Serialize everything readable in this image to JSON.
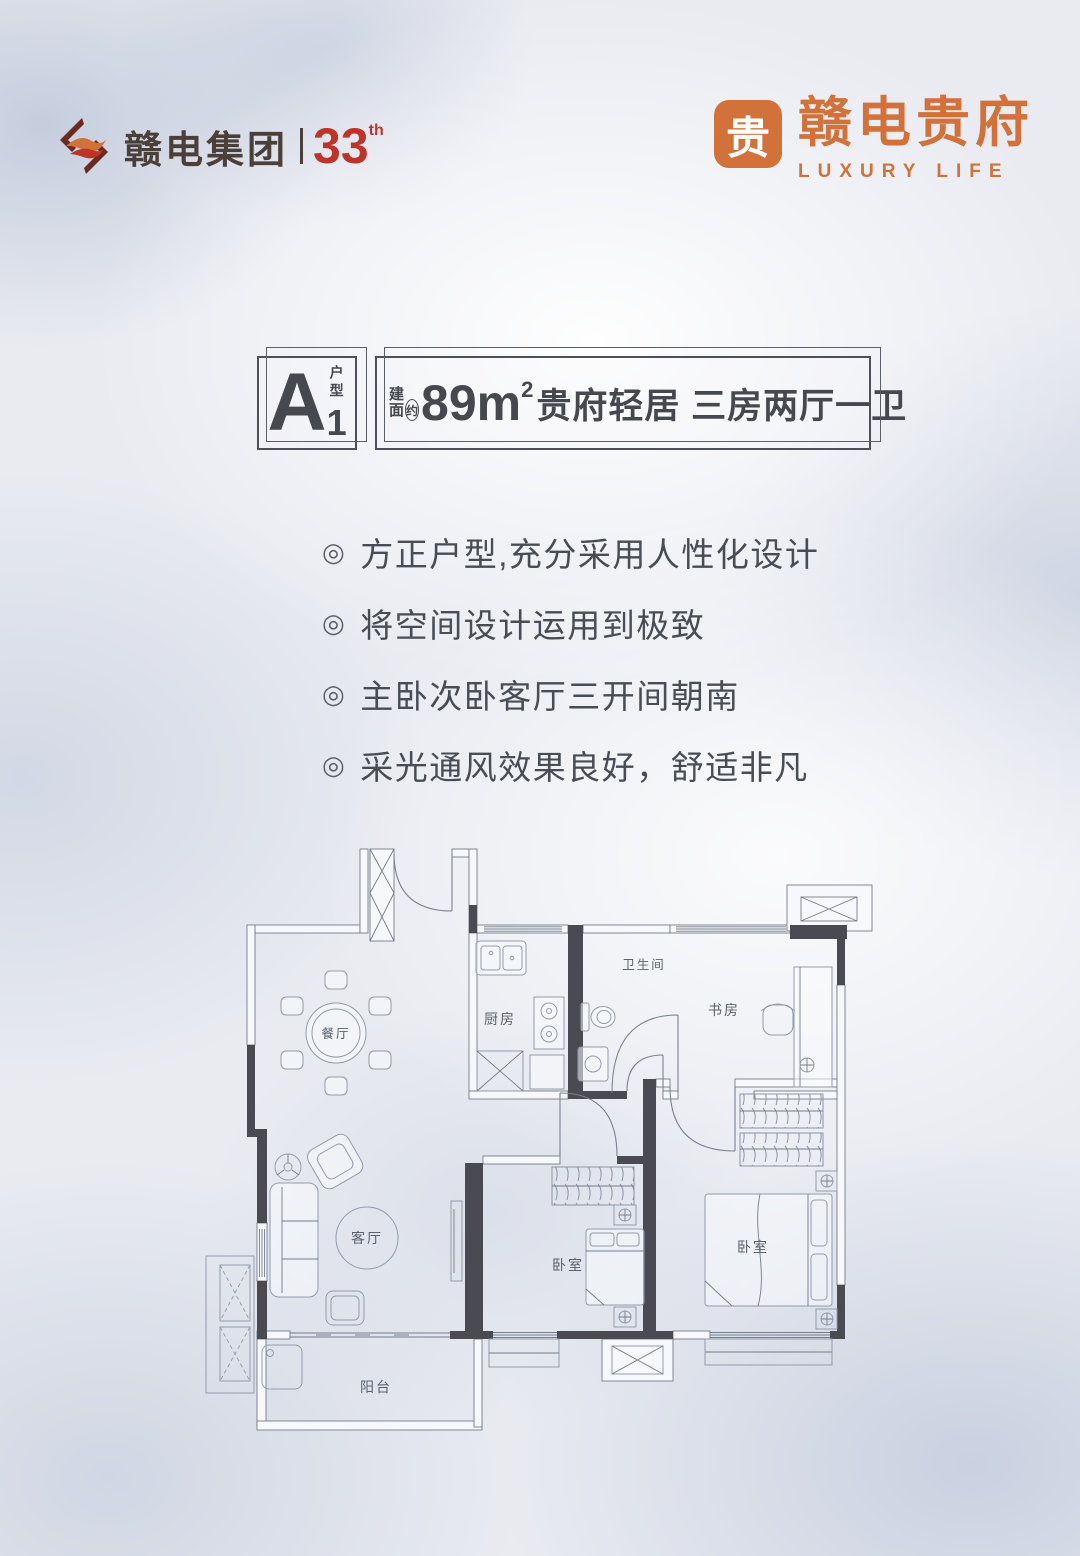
{
  "brand": {
    "group": {
      "name": "赣电集团",
      "anniversary": "33",
      "suffix": "th",
      "icon": "flame-bracket-icon"
    },
    "estate": {
      "seal": "贵",
      "name": "赣电贵府",
      "tagline": "LUXURY LIFE"
    }
  },
  "unit": {
    "letter": "A",
    "index": "1",
    "type_label": "户型",
    "area_label_top": "建",
    "area_label_bottom": "面",
    "area_approx": "约",
    "area_value": "89m",
    "area_sup": "2",
    "headline": "贵府轻居 三房两厅一卫"
  },
  "features": {
    "bullet": "◎",
    "items": [
      "方正户型,充分采用人性化设计",
      "将空间设计运用到极致",
      "主卧次卧客厅三开间朝南",
      "采光通风效果良好，舒适非凡"
    ]
  },
  "floorplan": {
    "rooms": {
      "dining": "餐厅",
      "kitchen": "厨房",
      "bath": "卫生间",
      "study": "书房",
      "living": "客厅",
      "bedroom_a": "卧室",
      "bedroom_b": "卧室",
      "balcony": "阳台"
    }
  },
  "colors": {
    "brand_orange": "#d2713a",
    "logo_red": "#bf3428",
    "logo_dark": "#4a4039",
    "ink": "#45484f",
    "wall_dark": "#4a4b52",
    "plan_line": "#747b8b"
  }
}
